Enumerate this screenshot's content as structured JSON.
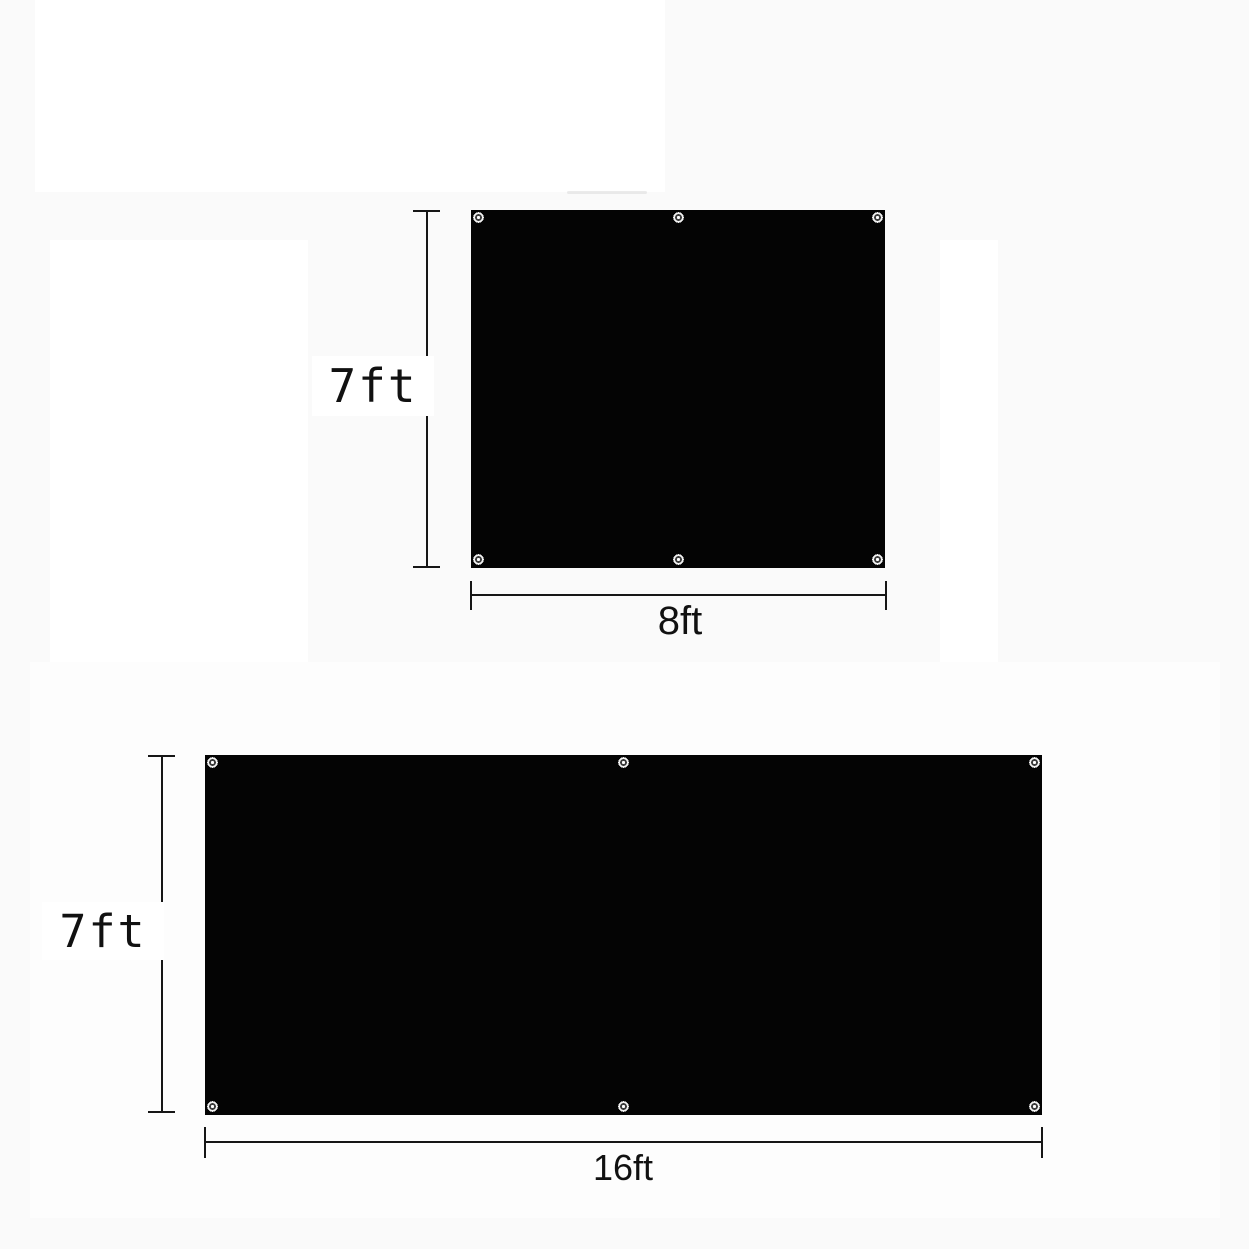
{
  "image": {
    "type": "product-dimension-diagram",
    "background_color": "#fafafa",
    "panel_color": "#040404",
    "line_color": "#161616",
    "grommet_icon": "metal-eyelet-ring"
  },
  "panels": [
    {
      "name": "panel-7ft-by-8ft",
      "height_label": "7ft",
      "width_label": "8ft",
      "height_ft": 7,
      "width_ft": 8,
      "grommet_count": 6,
      "grommet_positions": [
        "top-left",
        "top-center",
        "top-right",
        "bottom-left",
        "bottom-center",
        "bottom-right"
      ]
    },
    {
      "name": "panel-7ft-by-16ft",
      "height_label": "7ft",
      "width_label": "16ft",
      "height_ft": 7,
      "width_ft": 16,
      "grommet_count": 6,
      "grommet_positions": [
        "top-left",
        "top-center",
        "top-right",
        "bottom-left",
        "bottom-center",
        "bottom-right"
      ]
    }
  ]
}
